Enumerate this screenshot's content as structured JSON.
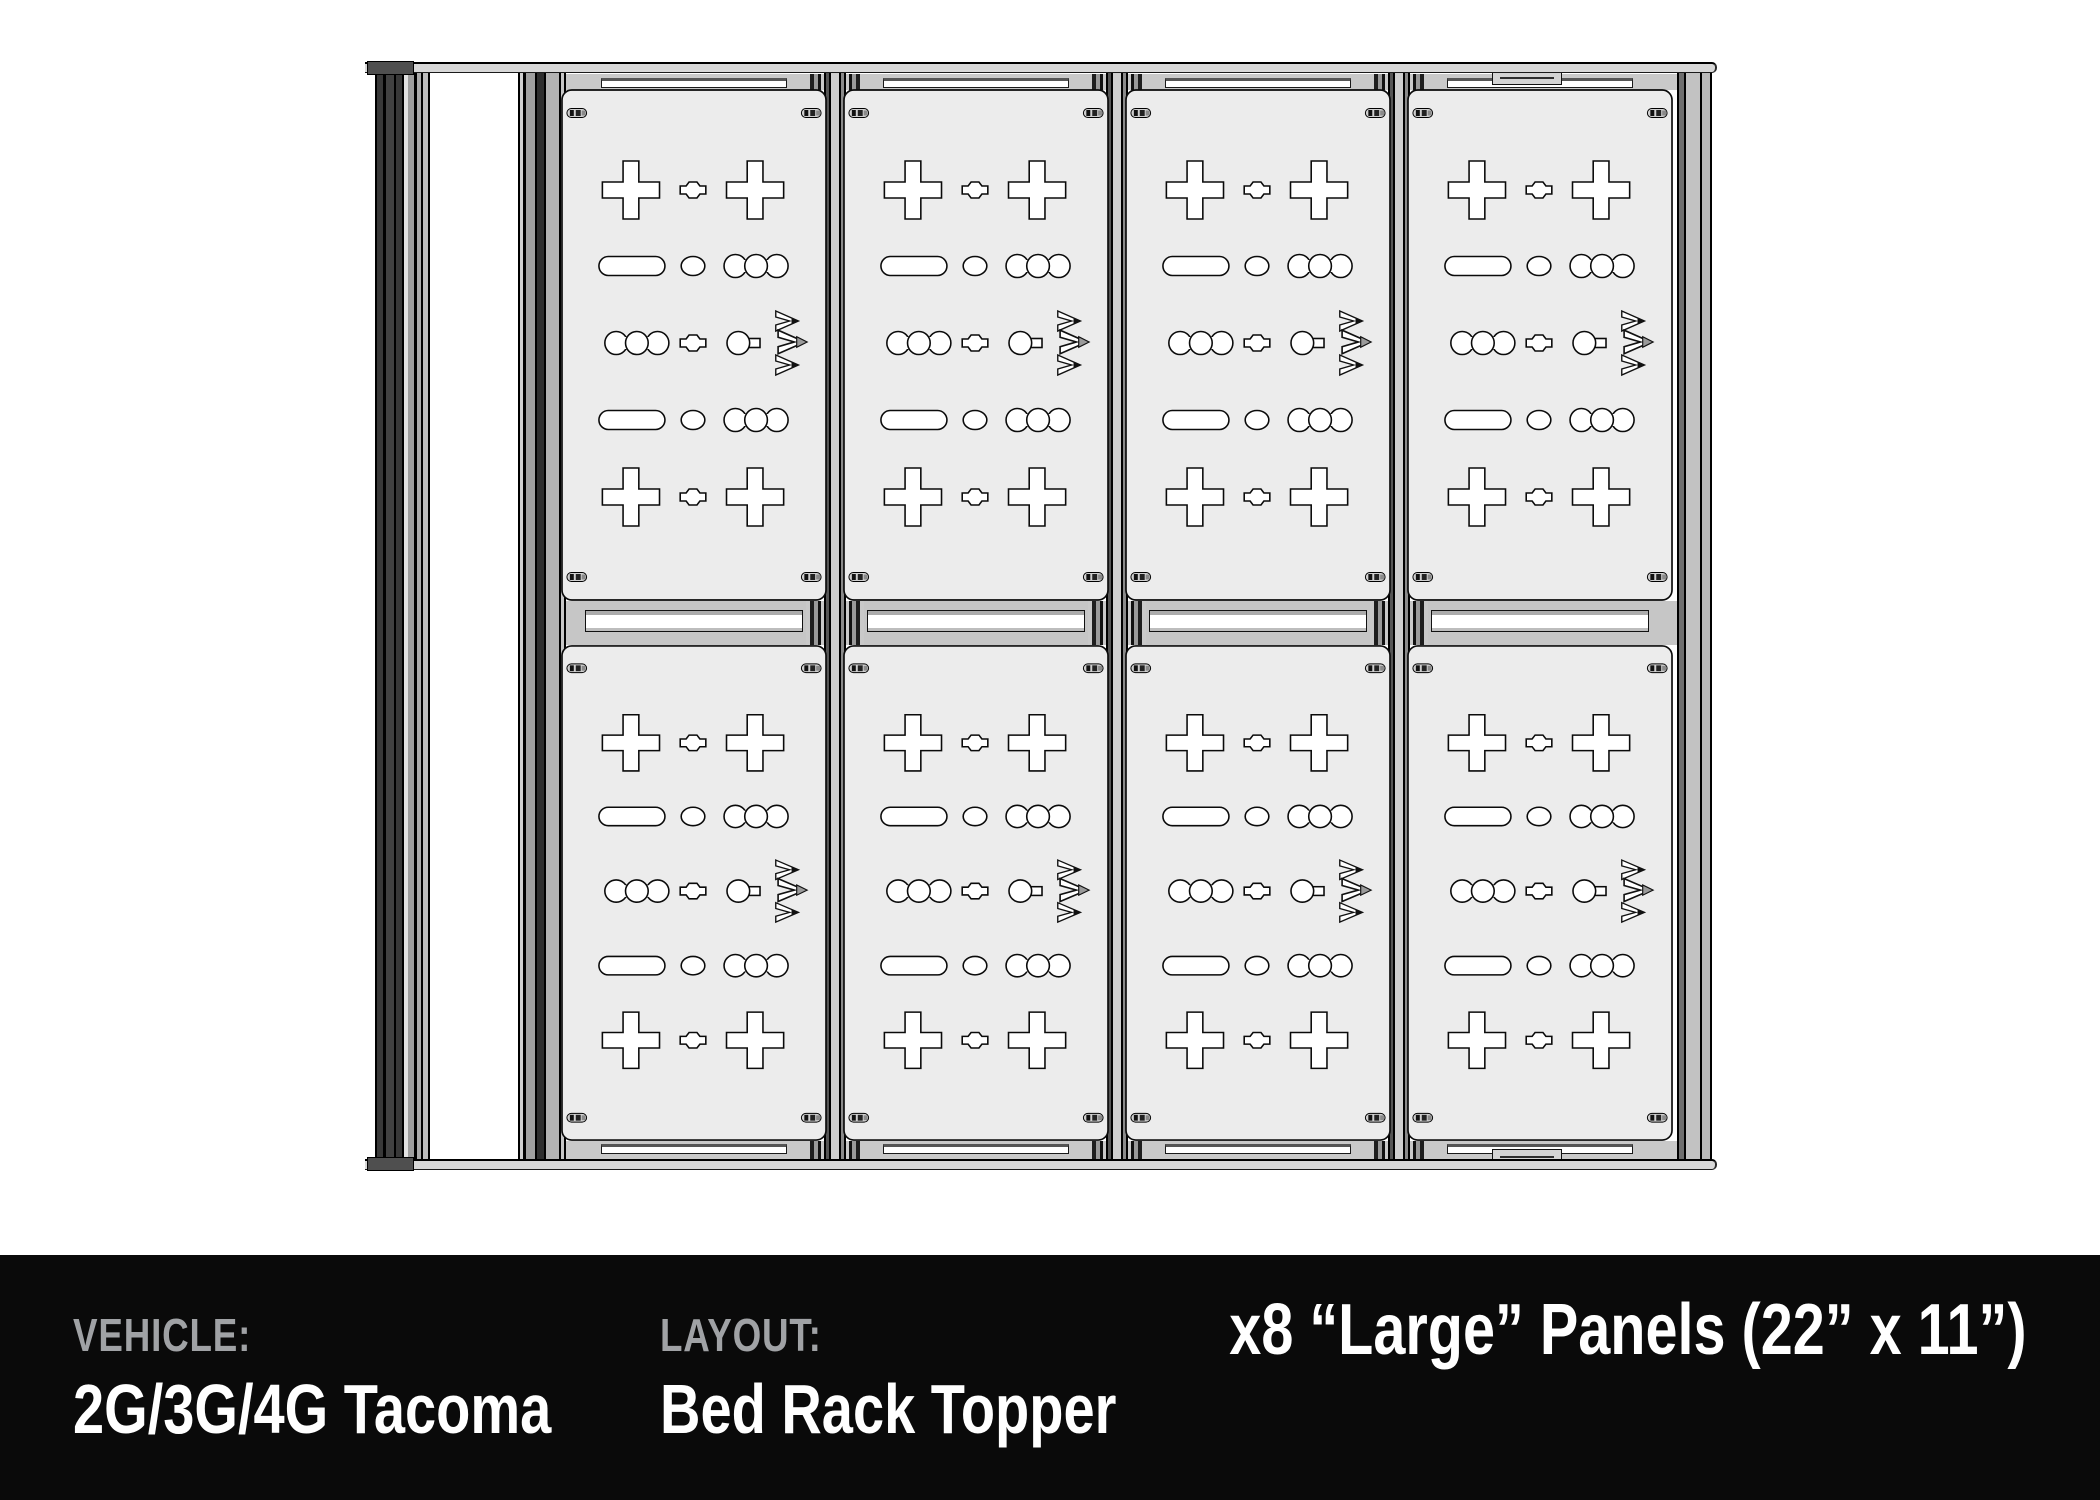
{
  "footer": {
    "vehicle_label": "VEHICLE:",
    "vehicle_value": "2G/3G/4G Tacoma",
    "layout_label": "LAYOUT:",
    "layout_value": "Bed Rack Topper",
    "panels_summary": "x8 “Large” Panels (22” x 11”)",
    "background_color": "#0a0a0a",
    "label_color": "#a0a2a5",
    "value_color": "#ffffff"
  },
  "drawing": {
    "description": "Top view technical drawing of a truck bed rack topper with modular accessory panels on extrusion rails",
    "panel_grid": {
      "rows": 2,
      "columns": 4,
      "count": 8,
      "panel_size_label": "Large 22 x 11"
    },
    "geometry": {
      "col_lefts": [
        196,
        478,
        760,
        1042
      ],
      "row_tops": [
        27,
        583
      ],
      "row_heights": [
        512,
        496
      ],
      "panel_width": 266,
      "boundary_rails": [
        459,
        741,
        1023
      ]
    },
    "panels": [
      {
        "id": "r1c1",
        "row": 0,
        "col": 0
      },
      {
        "id": "r1c2",
        "row": 0,
        "col": 1
      },
      {
        "id": "r1c3",
        "row": 0,
        "col": 2
      },
      {
        "id": "r1c4",
        "row": 0,
        "col": 3
      },
      {
        "id": "r2c1",
        "row": 1,
        "col": 0
      },
      {
        "id": "r2c2",
        "row": 1,
        "col": 1
      },
      {
        "id": "r2c3",
        "row": 1,
        "col": 2
      },
      {
        "id": "r2c4",
        "row": 1,
        "col": 3
      }
    ],
    "colors": {
      "panel_fill": "#ececec",
      "hole_fill": "#ffffff",
      "outline": "#0a0a0a",
      "zone_gray": "#c9c9c9",
      "bar_fill": "#d8d8d8",
      "bar_cap": "#4f4f4f"
    },
    "icons": [
      "mountain-logo-icon"
    ]
  }
}
